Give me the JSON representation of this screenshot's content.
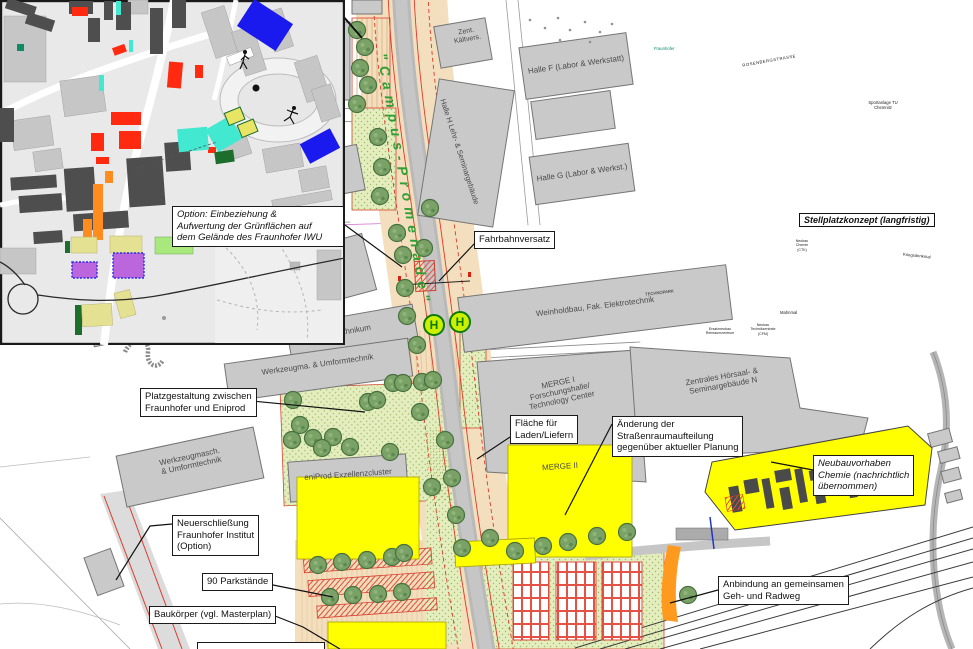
{
  "map": {
    "street": {
      "campus_promenade": "\"Campus-Promenade\""
    },
    "buildings": {
      "physik": "Institut für Physik",
      "trafo": "Trafo",
      "laborhalle": "Laborhalle/\nSchaumzentrum",
      "kaeltever": "Zent.\nKältvers.",
      "halle_f": "Halle F (Labor & Werkstatt)",
      "halle_g": "Halle G (Labor & Werkst.)",
      "halle_h": "Halle H  Lehr- & Seminargebäude",
      "mechatronik": "Institut für\nMechatronik",
      "maschinenhalle": "Maschinenhalle",
      "technikum": "Technikum",
      "weinholdbau": "Weinholdbau, Fak. Elektrotechnik",
      "werkzeugma": "Werkzeugma. & Umformtechnik",
      "werkzeugmasch": "Werkzeugmasch.\n& Umformtechnik",
      "eniprod": "eniProd Exzellenzcluster",
      "merge_1": "MERGE I\nForschungshalle/\nTechnology Center",
      "merge_2": "MERGE II",
      "hoersaal": "Zentrales Hörsaal- &\nSeminargebäude N"
    },
    "annotations": {
      "option_gruen": "Option: Einbeziehung &\nAufwertung der Grünflächen auf\ndem Gelände des Fraunhofer IWU",
      "fahrbahnversatz": "Fahrbahnversatz",
      "platzgestaltung": "Platzgestaltung zwischen\nFraunhofer und Eniprod",
      "laden_liefern": "Fläche für\nLaden/Liefern",
      "strassenraum": "Änderung der\nStraßenraumaufteilung\ngegenüber aktueller Planung",
      "neubau_chemie": "Neubauvorhaben\nChemie (nachrichtlich\nübernommen)",
      "neuerschliessung": "Neuerschließung\nFraunhofer Institut\n(Option)",
      "parkstaende": "90 Parkstände",
      "baukoerper": "Baukörper (vgl. Masterplan)",
      "anbindung": "Anbindung an gemeinsamen\nGeh- und Radweg"
    },
    "stops": {
      "haltestelle": "H"
    }
  },
  "inset": {
    "title": "Stellplatzkonzept (langfristig)",
    "labels": {
      "sportanlage": "Sportanlage TU\nChemnitz",
      "rosenbergstrasse": "ROSENBERGSTRASSE",
      "technopark": "TECHNOPARK",
      "kriegsdenkmal": "Kriegsdenkmal",
      "mahnmal": "Mahnmal",
      "fraunhofer": "Fraunhofer",
      "ersatzneubau": "Ersatzneubau\nReinraumzentrum",
      "technikzentrale": "Neubau\nTechnikzentrale\n(CFM)",
      "neubau_chemie_ctk": "Neubau\nChemie\n(CTK)"
    }
  },
  "colors": {
    "promenade_green": "#2f9e33",
    "building_gray": "#c9c9c9",
    "planning_yellow": "#ffff00",
    "planning_red": "#d84030",
    "inset_blue": "#1a1aee",
    "inset_red": "#ff2a10",
    "inset_cyan": "#42e8d0",
    "inset_orange": "#ff8c1e",
    "inset_purple": "#bb66dd",
    "stop_green": "#0a7a0a"
  }
}
